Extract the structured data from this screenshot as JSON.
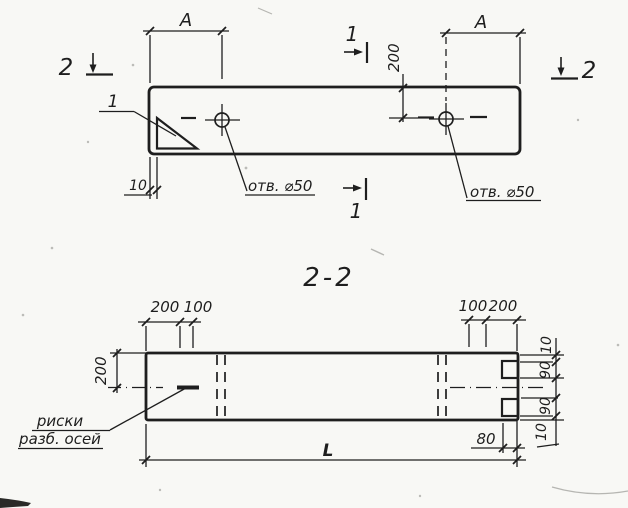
{
  "colors": {
    "ink": "#1e1e1e",
    "paper": "#f8f8f5"
  },
  "plan_view": {
    "dim_a_left": "A",
    "dim_a_right": "A",
    "dim_offset_200": "200",
    "dim_edge_10": "10",
    "detail_callout": "1",
    "section_marker_top": "1",
    "section_marker_bottom": "1",
    "section_marker_left": "2",
    "section_marker_right": "2",
    "hole_label_left": "отв. ⌀50",
    "hole_label_right": "отв. ⌀50"
  },
  "section_view": {
    "title": "2-2",
    "dim_top_left_200": "200",
    "dim_top_left_100": "100",
    "dim_top_right_100": "100",
    "dim_top_right_200": "200",
    "dim_left_200": "200",
    "dim_right_10_top": "10",
    "dim_right_90_top": "90",
    "dim_right_90_bottom": "90",
    "dim_right_10_bottom": "10",
    "dim_groove_80": "80",
    "dim_length": "L",
    "axis_note_line1": "риски",
    "axis_note_line2": "разб. осей"
  }
}
